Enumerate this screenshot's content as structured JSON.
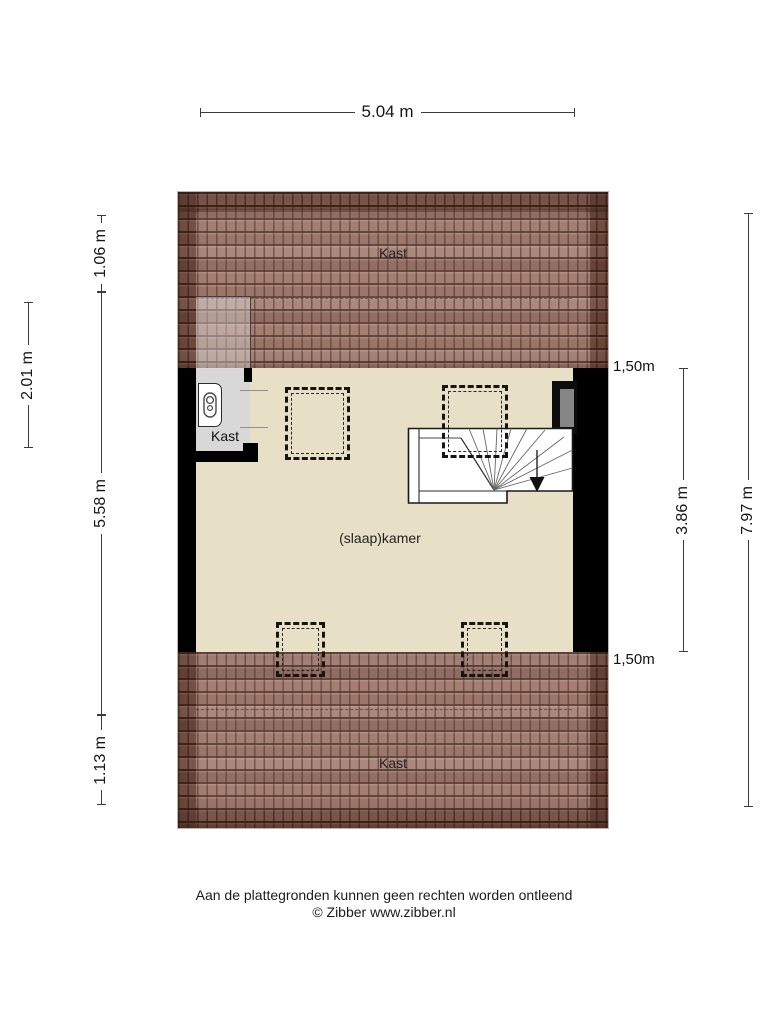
{
  "plan": {
    "rooms": {
      "attic_top": "Kast",
      "closet": "Kast",
      "bedroom": "(slaap)kamer",
      "attic_bottom": "Kast"
    },
    "knee_wall_top": "1,50m",
    "knee_wall_bottom": "1,50m"
  },
  "dimensions": {
    "top": "5.04 m",
    "left_outer": "2.01 m",
    "left_top": "1.06 m",
    "left_middle": "5.58 m",
    "left_bottom": "1.13 m",
    "right_inner": "3.86 m",
    "right_outer": "7.97 m"
  },
  "footer": {
    "disclaimer": "Aan de plattegronden kunnen geen rechten worden ontleend",
    "copyright": "© Zibber www.zibber.nl"
  },
  "colors": {
    "floor": "#e7dfc6",
    "roof_tile": "#96685a",
    "wall": "#000000",
    "closet_floor": "#d8d8d8",
    "window_glass": "#868686"
  }
}
